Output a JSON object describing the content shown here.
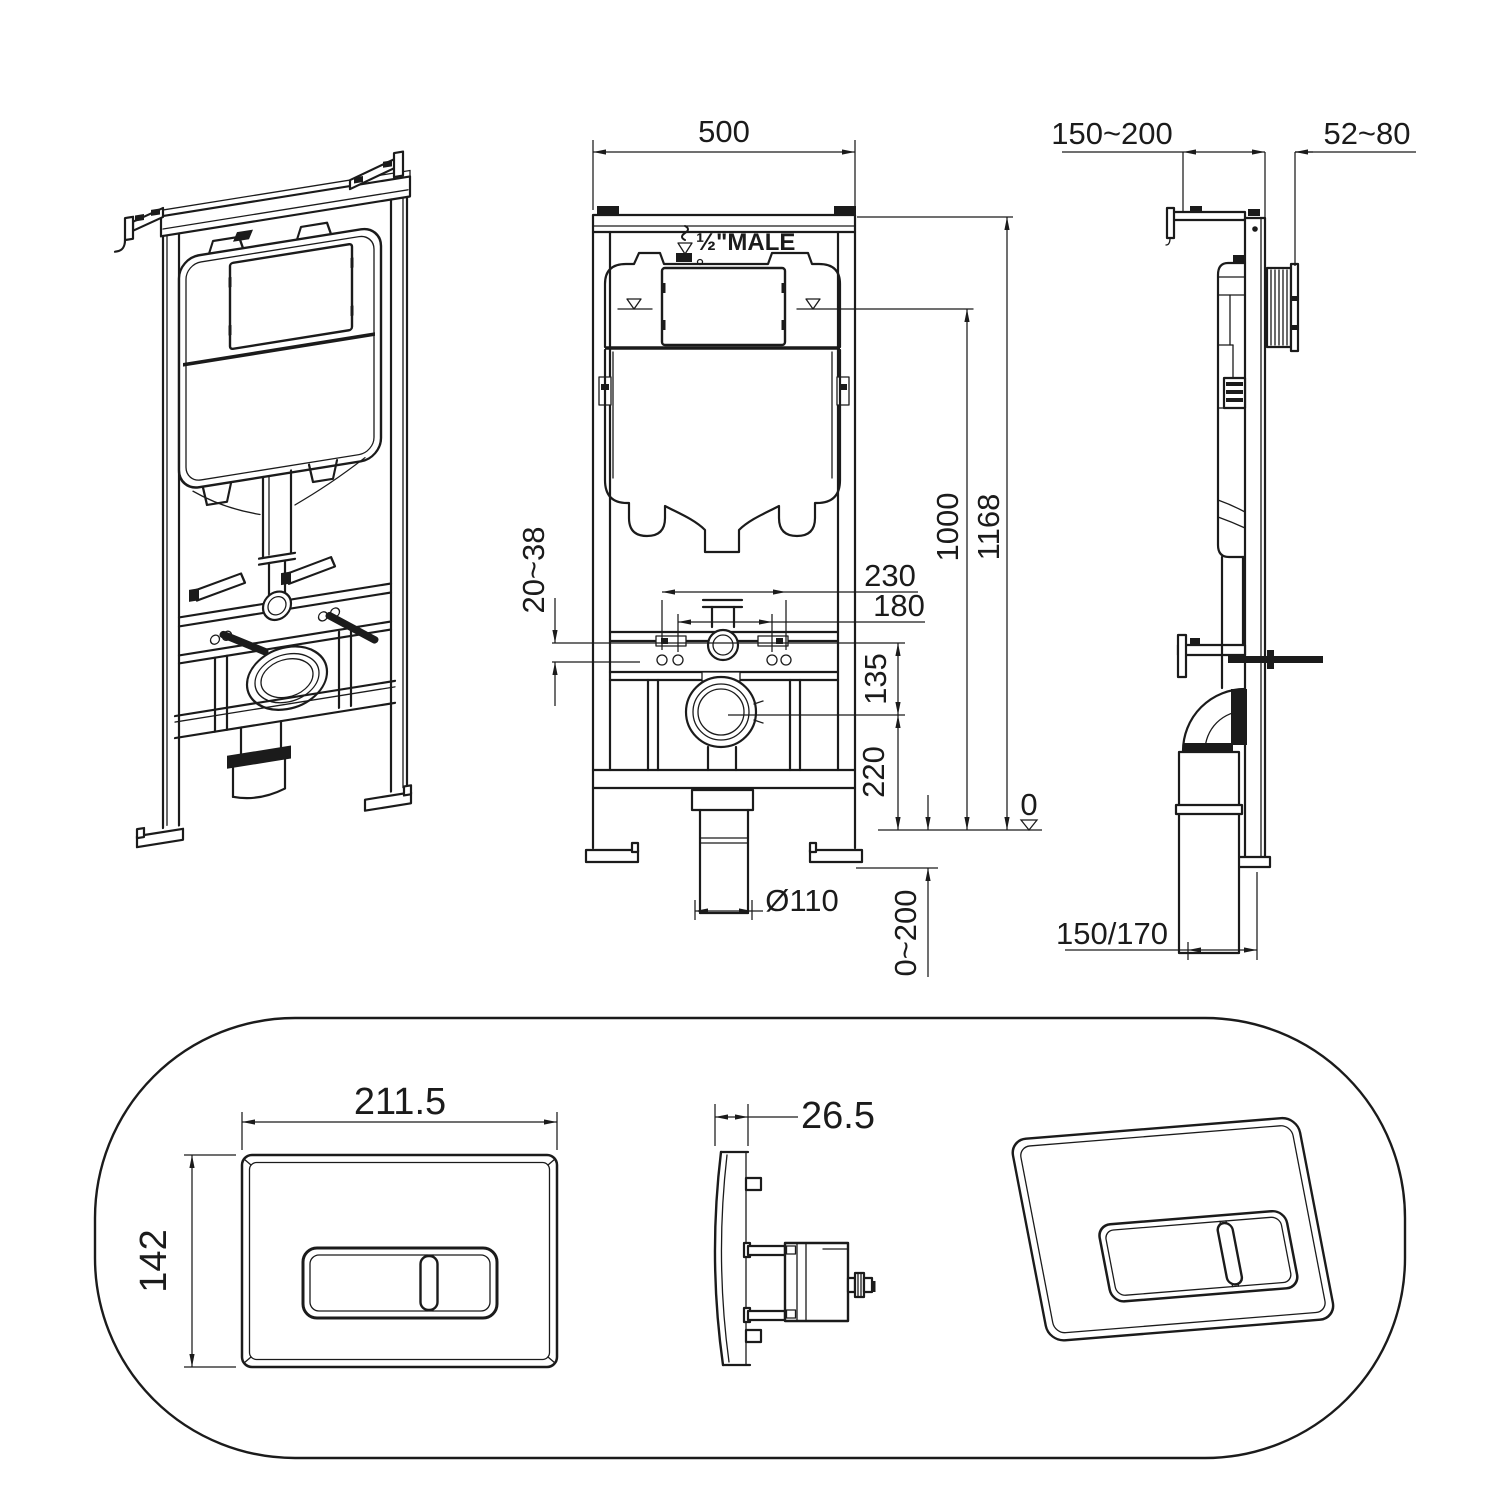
{
  "drawing": {
    "front": {
      "width": "500",
      "total_height": "1168",
      "tank_height": "1000",
      "fixing_span_outer": "230",
      "fixing_span_inner": "180",
      "fixing_offset": "20~38",
      "fixing_to_drain": "135",
      "drain_height": "220",
      "outlet_diameter": "Ø110",
      "floor_range": "0~200",
      "datum": "0",
      "supply_thread": "½\"MALE"
    },
    "side": {
      "frame_depth": "150~200",
      "actuator_depth": "52~80",
      "outlet_offset": "150/170"
    },
    "plate": {
      "width": "211.5",
      "height": "142",
      "thickness": "26.5"
    }
  }
}
